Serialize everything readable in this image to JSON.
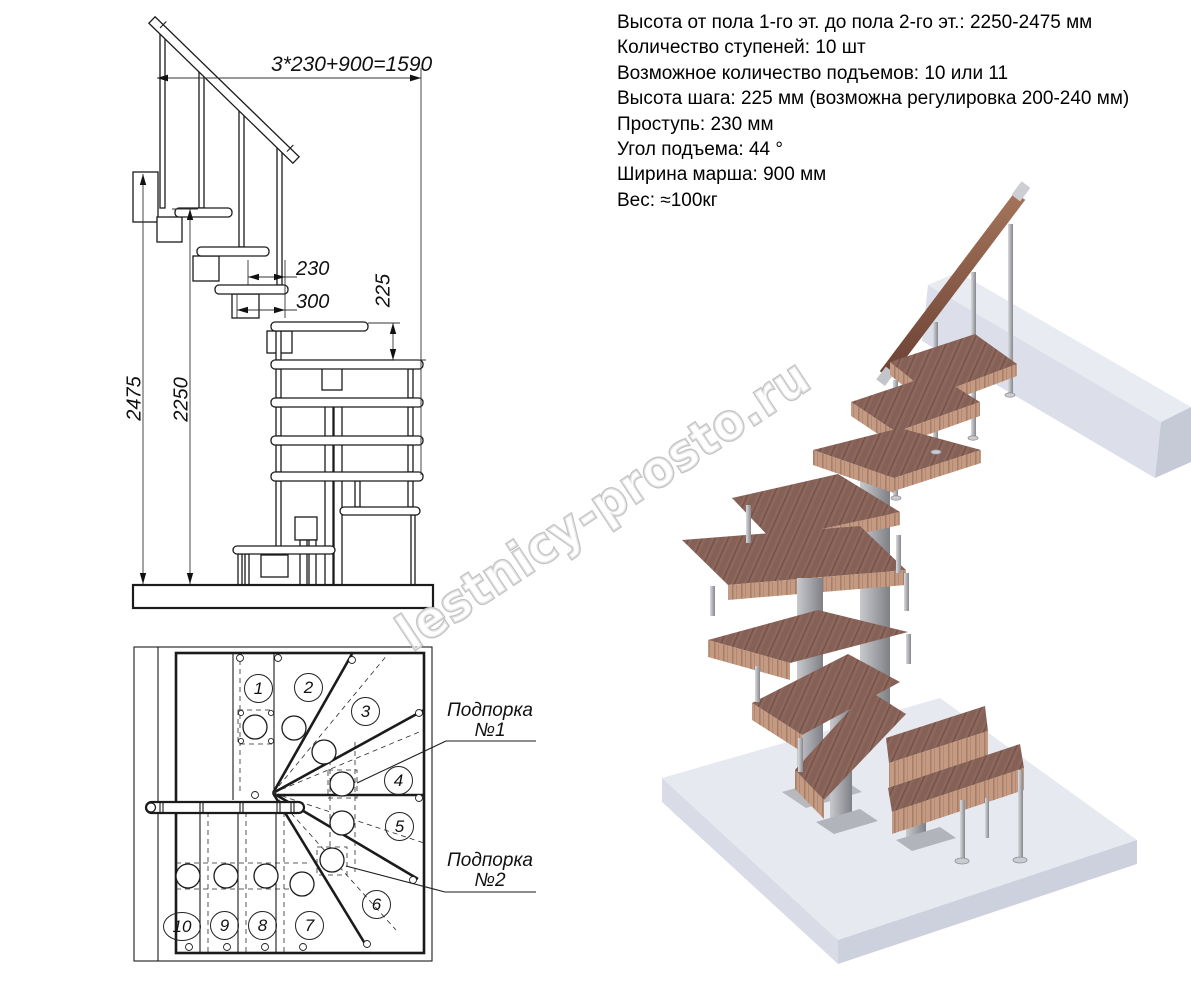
{
  "specs": {
    "lines": [
      "Высота от пола 1-го эт. до пола 2-го эт.: 2250-2475 мм",
      "Количество ступеней: 10 шт",
      "Возможное количество подъемов: 10 или 11",
      "Высота шага: 225 мм (возможна регулировка 200-240 мм)",
      "Проступь: 230 мм",
      "Угол подъема: 44 °",
      "Ширина марша: 900 мм",
      "Вес: ≈100кг"
    ]
  },
  "elevation": {
    "dim_total_run": "3*230+900=1590",
    "dim_tread_depth": "230",
    "dim_module_depth": "300",
    "dim_step_height": "225",
    "dim_height_max": "2475",
    "dim_height_min": "2250"
  },
  "plan": {
    "step_numbers": [
      "1",
      "2",
      "3",
      "4",
      "5",
      "6",
      "7",
      "8",
      "9",
      "10"
    ],
    "support1_line1": "Подпорка",
    "support1_line2": "№1",
    "support2_line1": "Подпорка",
    "support2_line2": "№2"
  },
  "watermark": "lestnicy-prosto.ru",
  "colors": {
    "wood_top": "#8d675c",
    "wood_edge": "#c49b82",
    "handrail": "#8a5a45",
    "metal": "#aeb0b5",
    "floor_top": "#e7e9f1",
    "floor_side": "#d4d7e2",
    "line": "#1b1b1b",
    "watermark_outline": "#c3c3c3"
  }
}
